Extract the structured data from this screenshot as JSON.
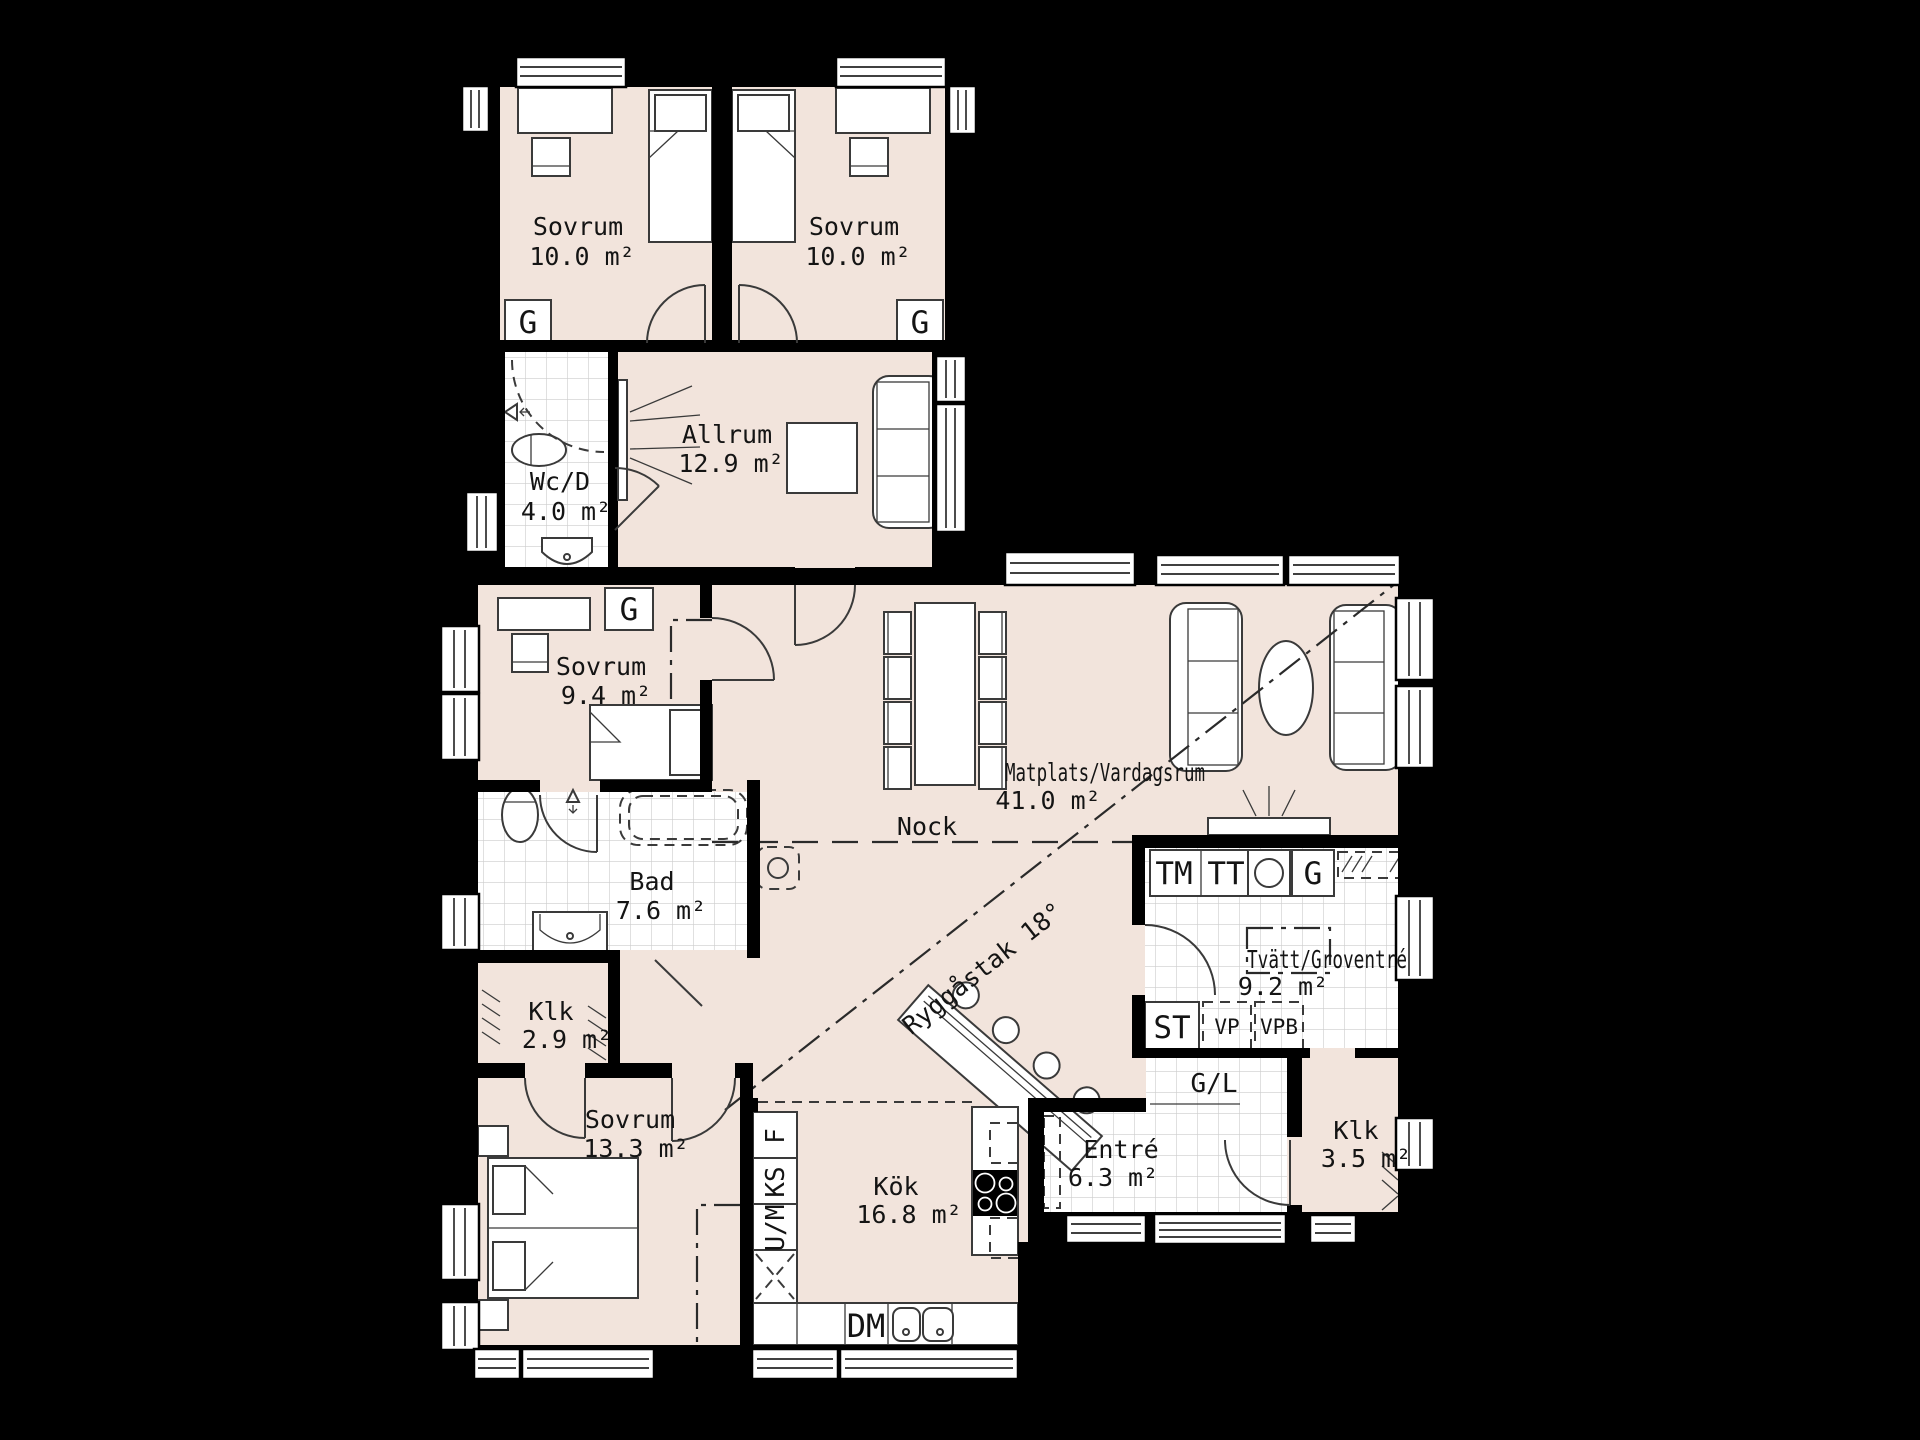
{
  "palette": {
    "background": "#000000",
    "floor": "#f2e4dc",
    "tile": "#ffffff",
    "tile_grid": "#cccccc",
    "wall": "#000000",
    "line": "#3a3a3a"
  },
  "rooms": {
    "sovrum1": {
      "name": "Sovrum",
      "area": "10.0 m²"
    },
    "sovrum2": {
      "name": "Sovrum",
      "area": "10.0 m²"
    },
    "wcd": {
      "name": "Wc/D",
      "area": "4.0 m²"
    },
    "allrum": {
      "name": "Allrum",
      "area": "12.9 m²"
    },
    "sovrum3": {
      "name": "Sovrum",
      "area": "9.4 m²"
    },
    "bad": {
      "name": "Bad",
      "area": "7.6 m²"
    },
    "klk1": {
      "name": "Klk",
      "area": "2.9 m²"
    },
    "sovrum4": {
      "name": "Sovrum",
      "area": "13.3 m²"
    },
    "matplats": {
      "name": "Matplats/Vardagsrum",
      "area": "41.0 m²"
    },
    "kok": {
      "name": "Kök",
      "area": "16.8 m²"
    },
    "entre": {
      "name": "Entré",
      "area": "6.3 m²"
    },
    "klk2": {
      "name": "Klk",
      "area": "3.5 m²"
    },
    "tvatt": {
      "name": "Tvätt/Groventré",
      "area": "9.2 m²"
    }
  },
  "annotations": {
    "nock": "Nock",
    "ryggastak": "Ryggåstak 18°"
  },
  "markers": {
    "wardrobe": "G",
    "wardrobe_linen": "G/L",
    "washer": "TM",
    "dryer": "TT",
    "cleaning": "ST",
    "heat_pump": "VP",
    "water_heater": "VPB",
    "dishwasher": "DM",
    "oven_micro": "U/M",
    "fridge": "KS",
    "freezer": "F"
  }
}
